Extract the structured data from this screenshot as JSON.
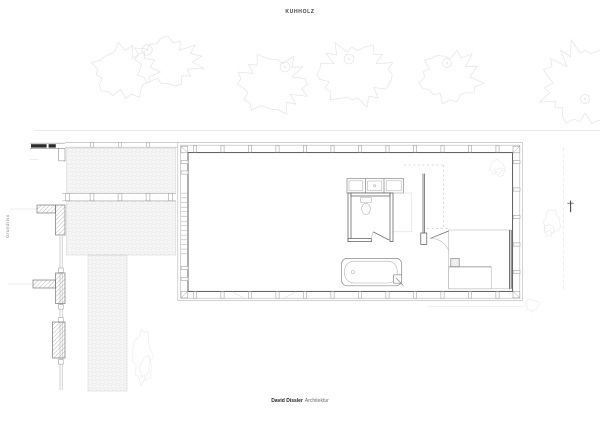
{
  "document": {
    "title": "KUHHOLZ",
    "side_label": "Grundriss",
    "footer": {
      "studio_name": "David Dissler",
      "studio_suffix": "Architektur"
    }
  },
  "drawing": {
    "colors": {
      "paper": "#ffffff",
      "ink": "#3c3c3c",
      "faint": "#e4e4e4",
      "paving_line": "#d9d9d9",
      "light_line": "#b5b5b5",
      "wall_dark": "#4a4a4a",
      "fixture": "#8a8a8a"
    }
  }
}
